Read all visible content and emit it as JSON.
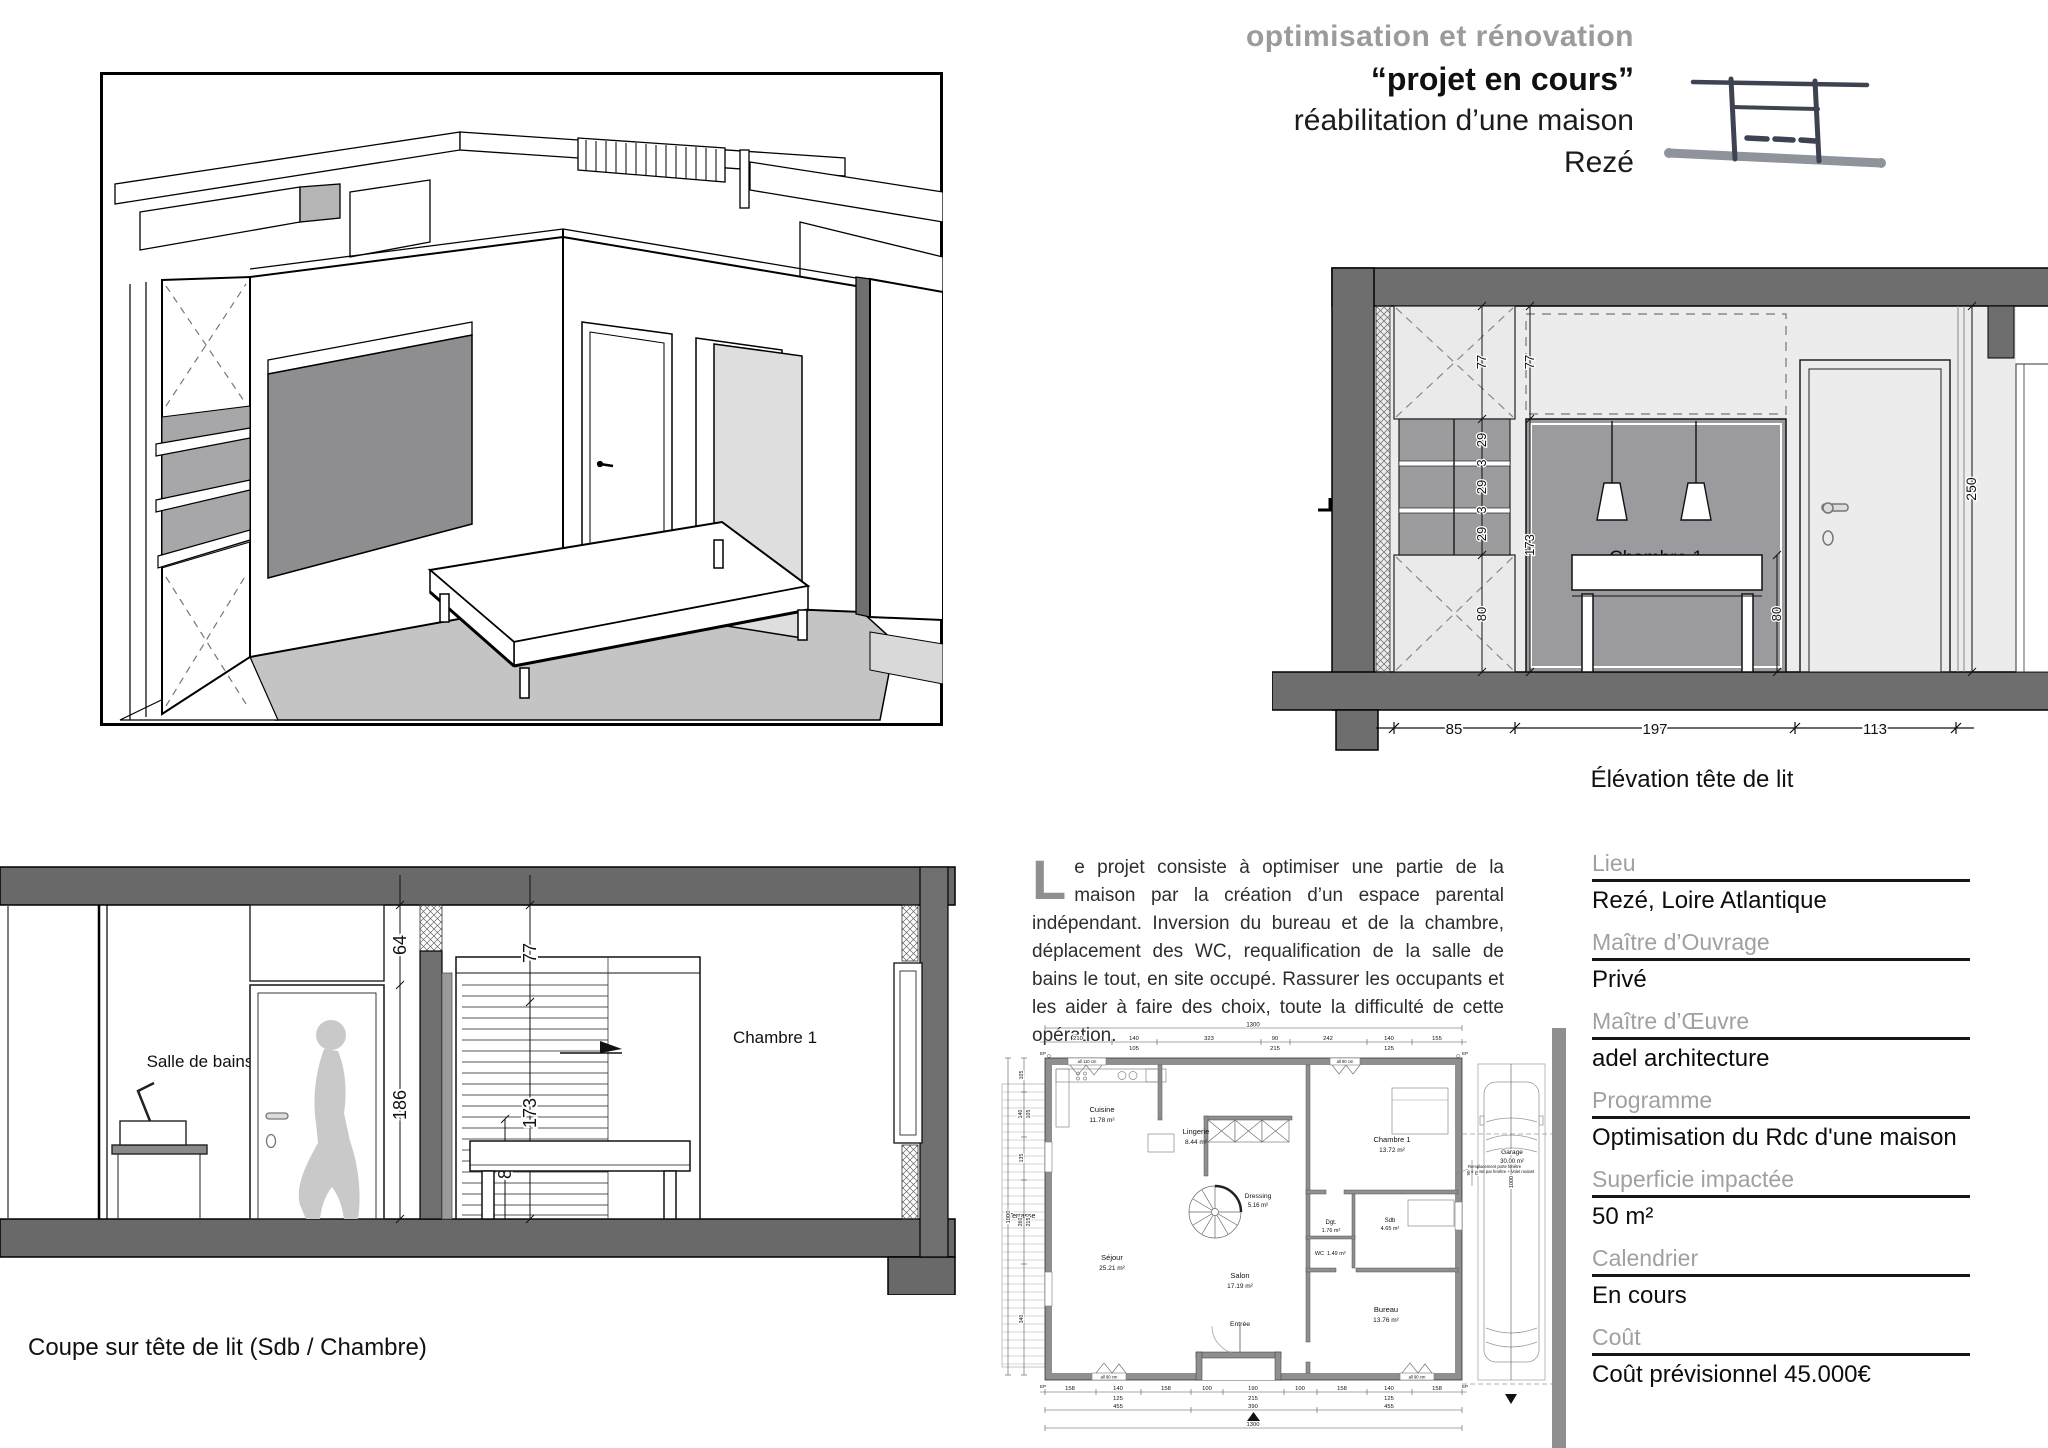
{
  "header": {
    "line1": "optimisation et rénovation",
    "line2": "“projet en cours”",
    "line3": "réabilitation d’une maison",
    "line4": "Rezé"
  },
  "description": {
    "drop_cap": "L",
    "text": "e projet consiste à optimiser une partie de la maison par la création d’un espace parental indépendant. Inversion du bureau et de la chambre, déplacement des WC, requalification de la salle de bains le tout, en site occupé. Rassurer les occupants et les aider à faire des choix, toute la difficulté de cette opération."
  },
  "elevation": {
    "caption": "Élévation tête de lit",
    "room": "Chambre 1",
    "col_dims": [
      "77",
      "29",
      "3",
      "29",
      "3",
      "29",
      "80"
    ],
    "mid_dims": [
      "77",
      "173"
    ],
    "bed_height": "80",
    "door_height": "250",
    "bottom_chain": [
      "85",
      "197",
      "113"
    ]
  },
  "section": {
    "caption": "Coupe sur tête de lit (Sdb / Chambre)",
    "label_bath": "Salle de bains",
    "label_room": "Chambre  1",
    "dim_transom": "64",
    "dim_door": "186",
    "dim_top": "77",
    "dim_headboard": "173",
    "dim_bed": "80"
  },
  "plan": {
    "overall_width": "1300",
    "overall_depth": "1000",
    "top_chain": [
      "210",
      "140",
      "323",
      "90",
      "242",
      "140",
      "155"
    ],
    "top_secondary": [
      "105",
      "215",
      "125"
    ],
    "left_chain": [
      "105",
      "140",
      "135",
      "260",
      "340"
    ],
    "left_secondary": [
      "105",
      "215"
    ],
    "bottom_chain": [
      "158",
      "140",
      "158",
      "100",
      "190",
      "100",
      "158",
      "140",
      "158"
    ],
    "bottom_secondary": [
      "125",
      "215",
      "125"
    ],
    "bottom_chain2": [
      "455",
      "390",
      "455"
    ],
    "side_dims": [
      "90",
      "75"
    ],
    "garage_depth": "1000",
    "ep_label": "EP",
    "note_line1": "Remplacement porte fenêtre",
    "note_line2": "existante par fenêtre + Volet roulant",
    "window_notes": [
      "all 110 cm",
      "all 90 cm",
      "all 90 cm",
      "all 90 cm"
    ],
    "rooms": [
      {
        "name": "Cuisine",
        "area": "11.78 m²"
      },
      {
        "name": "Lingerie",
        "area": "8.44 m²"
      },
      {
        "name": "Chambre 1",
        "area": "13.72 m²"
      },
      {
        "name": "Dressing",
        "area": "5.16 m²"
      },
      {
        "name": "Dgt.",
        "area": "1.76 m²"
      },
      {
        "name": "Sdb",
        "area": "4.65 m²"
      },
      {
        "name": "WC",
        "area": "1.49 m²"
      },
      {
        "name": "Séjour",
        "area": "25.21 m²"
      },
      {
        "name": "Salon",
        "area": "17.19 m²"
      },
      {
        "name": "Entrée",
        "area": ""
      },
      {
        "name": "Bureau",
        "area": "13.76 m²"
      },
      {
        "name": "Garage",
        "area": "30.00 m²"
      },
      {
        "name": "Terrasse",
        "area": ""
      }
    ],
    "info_colors": {
      "wall": "#8f8f8f"
    }
  },
  "info": {
    "items": [
      {
        "label": "Lieu",
        "value": "Rezé, Loire Atlantique"
      },
      {
        "label": "Maître d’Ouvrage",
        "value": "Privé"
      },
      {
        "label": "Maître d’Œuvre",
        "value": "adel architecture"
      },
      {
        "label": "Programme",
        "value": "Optimisation du Rdc d'une maison"
      },
      {
        "label": "Superficie impactée",
        "value": "50 m²"
      },
      {
        "label": "Calendrier",
        "value": "En cours"
      },
      {
        "label": "Coût",
        "value": "Coût prévisionnel 45.000€"
      }
    ]
  },
  "colors": {
    "title_gray": "#9b9b9b",
    "wall_dark": "#6e6e6e",
    "panel_light": "#eaeaea",
    "headboard_gray": "#9b9b9f",
    "floor_3d": "#c4c4c4",
    "plan_wall": "#8f8f8f",
    "ink_sketch": "#3d4350"
  }
}
